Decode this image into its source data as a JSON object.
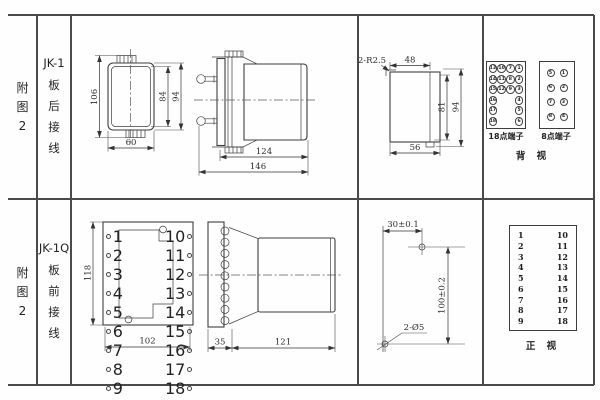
{
  "colors": {
    "grid_line": "#4a4a4a",
    "drawing_line": "#3e3e3e",
    "dim_text": "#2d2d2d",
    "background": "#fefefe"
  },
  "left_panel": {
    "top": {
      "index": "附图2",
      "model": "JK-1",
      "wiring": "板后接线"
    },
    "bottom": {
      "index": "附图2",
      "model": "JK-1Q",
      "wiring": "板前接线"
    }
  },
  "jk1": {
    "front_dims": {
      "h106": "106",
      "h84": "84",
      "h94": "94",
      "w60": "60"
    },
    "side_dims": {
      "d124": "124",
      "d146": "146"
    },
    "cutout_dims": {
      "radius": "2-R2.5",
      "w48": "48",
      "h81": "81",
      "h94": "94",
      "w56": "56"
    },
    "back_view": {
      "p18_label": "18点端子",
      "p8_label": "8点端子",
      "view_label": "背 视",
      "p18_rows": [
        [
          "13",
          "10",
          "7",
          "1"
        ],
        [
          "14",
          "11",
          "8",
          "2"
        ],
        [
          "15",
          "12",
          "9",
          "3"
        ],
        [
          "16",
          "",
          "",
          "4"
        ],
        [
          "17",
          "",
          "",
          "5"
        ],
        [
          "18",
          "",
          "",
          "6"
        ]
      ],
      "p8_rows": [
        [
          "5",
          "1"
        ],
        [
          "6",
          "2"
        ],
        [
          "7",
          "3"
        ],
        [
          "8",
          "4"
        ]
      ]
    }
  },
  "jk1q": {
    "front_dims": {
      "h118": "118",
      "w102": "102"
    },
    "left_terminals": [
      "1",
      "2",
      "3",
      "4",
      "5",
      "6",
      "7",
      "8",
      "9"
    ],
    "right_terminals": [
      "10",
      "11",
      "12",
      "13",
      "14",
      "15",
      "16",
      "17",
      "18"
    ],
    "side_dims": {
      "d35": "35",
      "d121": "121"
    },
    "drill_dims": {
      "top": "30±0.1",
      "right": "100±0.2",
      "holes": "2-Ø5"
    },
    "front_table": {
      "left": [
        "1",
        "2",
        "3",
        "4",
        "5",
        "6",
        "7",
        "8",
        "9"
      ],
      "right": [
        "10",
        "11",
        "12",
        "13",
        "14",
        "15",
        "16",
        "17",
        "18"
      ],
      "view_label": "正 视"
    }
  }
}
